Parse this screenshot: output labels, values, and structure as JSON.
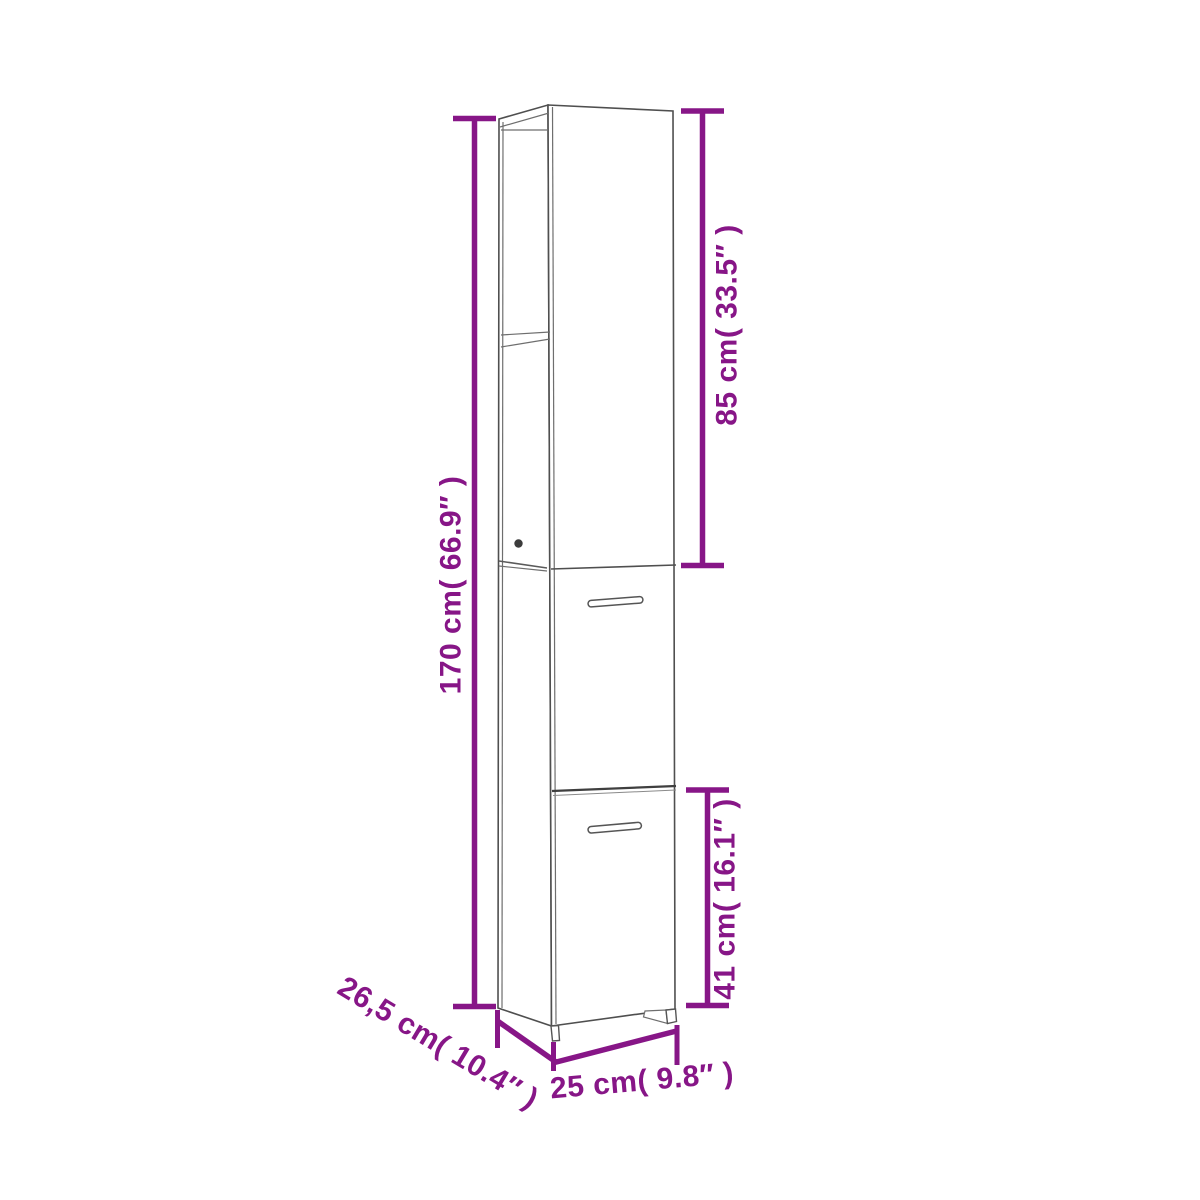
{
  "diagram": {
    "background_color": "#ffffff",
    "dimension_color": "#871687",
    "cabinet_line_color": "#4f4f4f",
    "labels": {
      "total_height": "170 cm( 66.9″ )",
      "upper_section_height": "85 cm( 33.5″ )",
      "lower_door_height": "41 cm( 16.1″ )",
      "depth": "26,5 cm( 10.4″ )",
      "width": "25 cm( 9.8″ )"
    }
  }
}
